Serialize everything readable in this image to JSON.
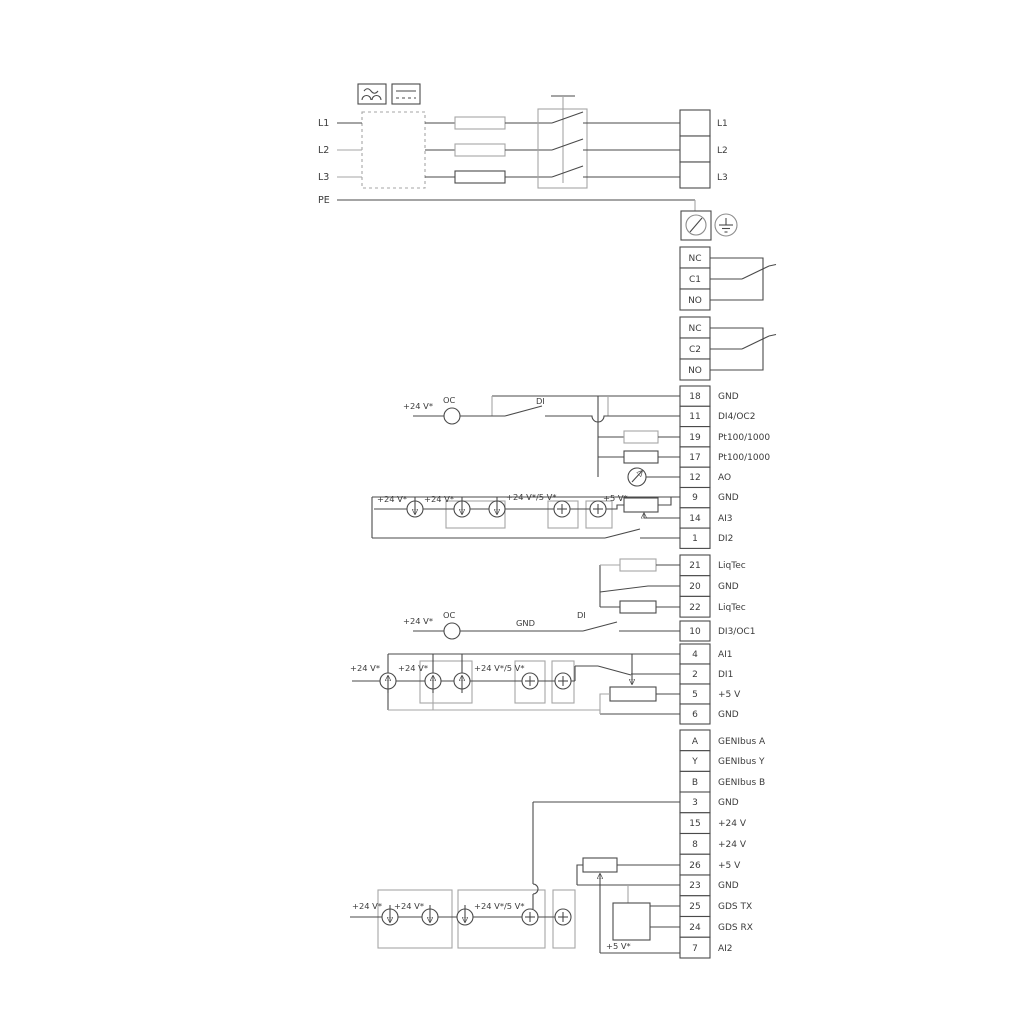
{
  "power": {
    "inputs": [
      "L1",
      "L2",
      "L3"
    ],
    "pe_label": "PE",
    "outputs": [
      "L1",
      "L2",
      "L3"
    ]
  },
  "relay1": [
    "NC",
    "C1",
    "NO"
  ],
  "relay2": [
    "NC",
    "C2",
    "NO"
  ],
  "io1": {
    "nums": [
      "18",
      "11",
      "19",
      "17",
      "12",
      "9",
      "14",
      "1"
    ],
    "labels": [
      "GND",
      "DI4/OC2",
      "Pt100/1000",
      "Pt100/1000",
      "AO",
      "GND",
      "AI3",
      "DI2"
    ]
  },
  "liqtec": {
    "nums": [
      "21",
      "20",
      "22"
    ],
    "labels": [
      "LiqTec",
      "GND",
      "LiqTec"
    ]
  },
  "di3": {
    "num": "10",
    "label": "DI3/OC1"
  },
  "ai1": {
    "nums": [
      "4",
      "2",
      "5",
      "6"
    ],
    "labels": [
      "AI1",
      "DI1",
      "+5 V",
      "GND"
    ]
  },
  "genibus": {
    "nums": [
      "A",
      "Y",
      "B"
    ],
    "labels": [
      "GENIbus A",
      "GENIbus Y",
      "GENIbus B"
    ]
  },
  "bottom": {
    "nums": [
      "3",
      "15",
      "8",
      "26",
      "23",
      "25",
      "24",
      "7"
    ],
    "labels": [
      "GND",
      "+24 V",
      "+24 V",
      "+5 V",
      "GND",
      "GDS TX",
      "GDS RX",
      "AI2"
    ]
  },
  "floating": {
    "v24": "+24 V*",
    "v24v5": "+24 V*/5 V*",
    "v5": "+5 V*",
    "oc": "OC",
    "di": "DI",
    "gnd": "GND"
  },
  "colors": {
    "wire": "#4a4a4a",
    "aux": "#a6a6a6",
    "text": "#3b3b3b"
  }
}
